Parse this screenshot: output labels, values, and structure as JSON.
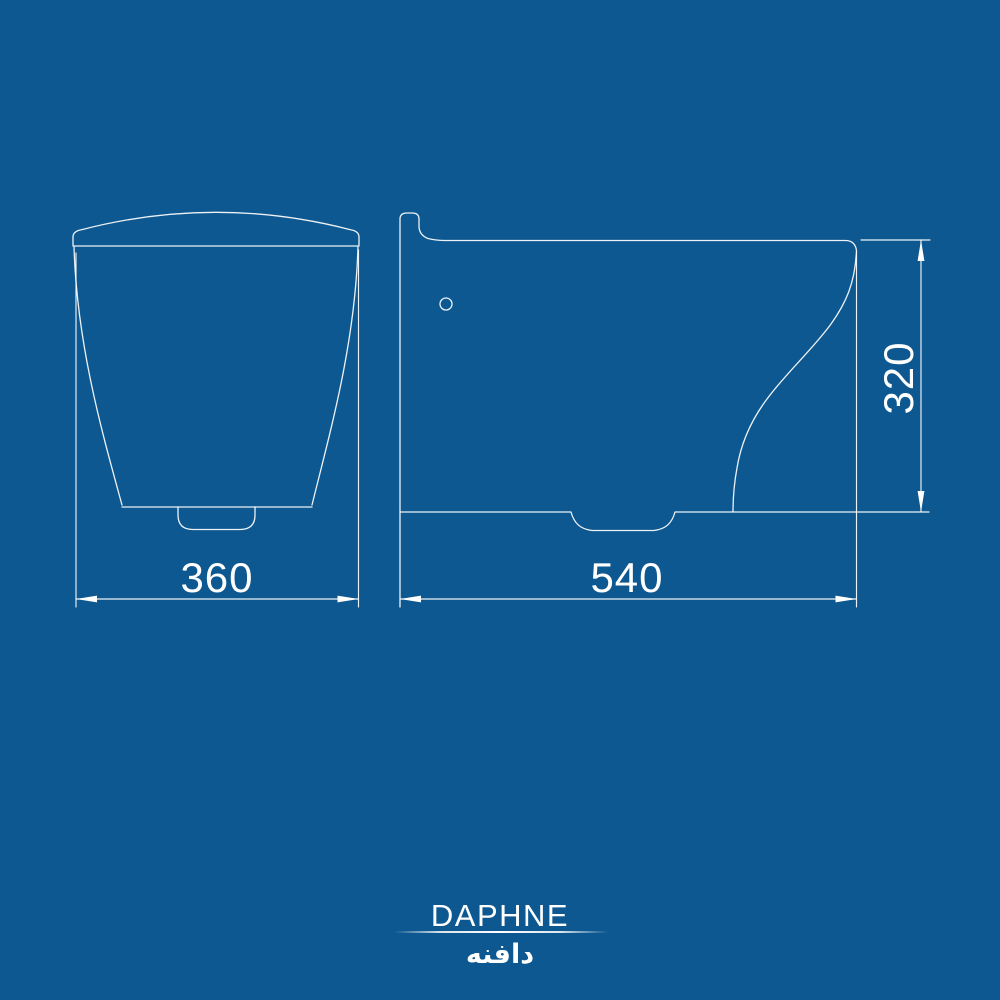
{
  "product": {
    "brand_latin": "DAPHNE",
    "brand_persian": "دافنه"
  },
  "drawing": {
    "subject": "wall-hung toilet technical drawing",
    "views": {
      "front": {
        "name": "front elevation",
        "width_label": "360"
      },
      "side": {
        "name": "side elevation",
        "depth_label": "540",
        "height_label": "320"
      }
    }
  },
  "colors": {
    "background": "#0d5890",
    "line": "#ffffff",
    "text": "#ffffff"
  }
}
